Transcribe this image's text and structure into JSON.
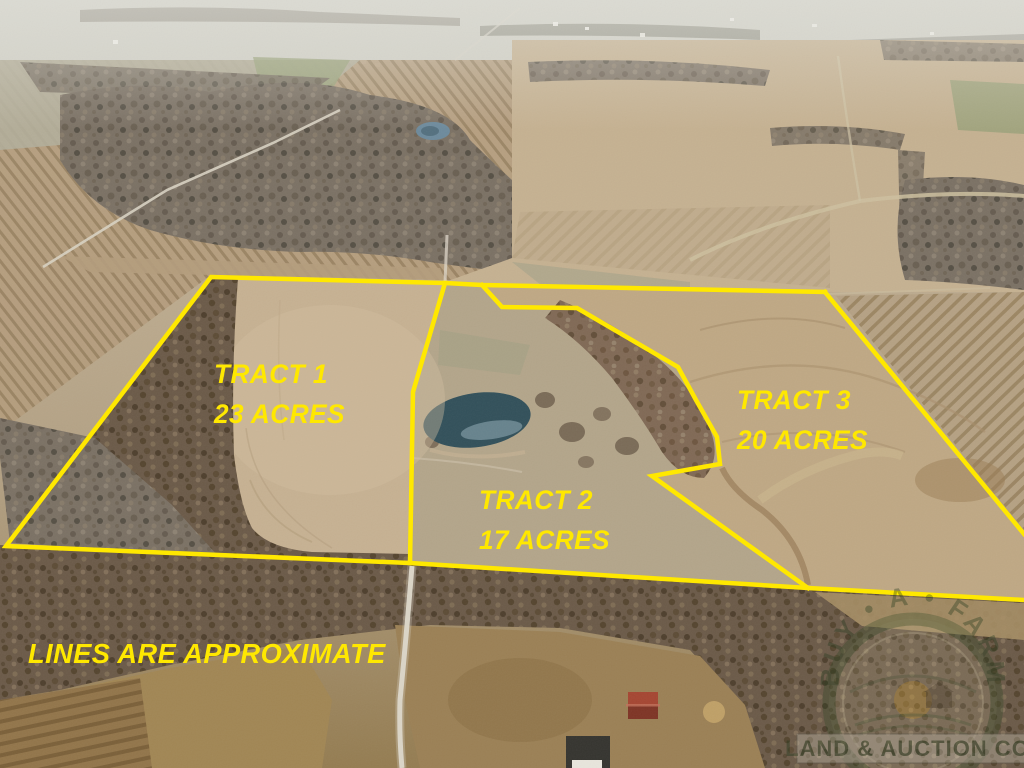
{
  "scene": {
    "description": "Aerial photo of winter farmland with three auction tracts outlined in yellow"
  },
  "tracts": [
    {
      "name": "TRACT 1",
      "acres": "23 ACRES"
    },
    {
      "name": "TRACT 2",
      "acres": "17 ACRES"
    },
    {
      "name": "TRACT 3",
      "acres": "20 ACRES"
    }
  ],
  "disclaimer": "LINES ARE APPROXIMATE",
  "watermark": {
    "arc_text": "BUY • A • FARM",
    "banner_text": "LAND & AUCTION CO."
  },
  "colors": {
    "boundary_line": "#FFE800",
    "label_text": "#FFE800"
  }
}
